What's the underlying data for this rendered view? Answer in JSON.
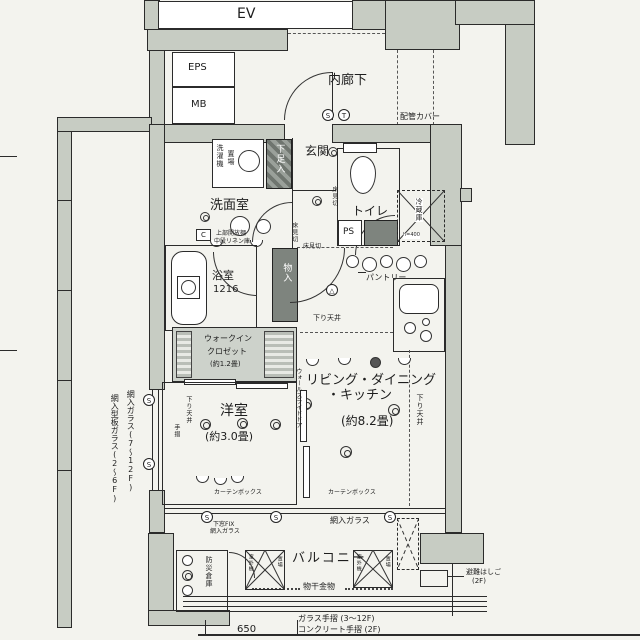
{
  "colors": {
    "wall": "#c7ccc3",
    "paper": "#f3f3ee",
    "line": "#2b2b2b",
    "dark_box": "#7e847e",
    "wic_tint": "#cdd2cb"
  },
  "plan": {
    "ev": "EV",
    "eps": "EPS",
    "mb": "MB",
    "corridor": "内廊下",
    "pipe_cover": "配管カバー",
    "entrance": "玄関",
    "shoe_box": "下足入",
    "washer1": "洗濯機",
    "washer2": "置場",
    "washroom": "洗面室",
    "shelf1": "上部開放棚",
    "shelf2": "中段リネン庫",
    "c": "C",
    "toilet": "トイレ",
    "ps": "PS",
    "fridge": "冷蔵庫",
    "fridge_note": "h=400",
    "pantry": "パントリー",
    "bath": "浴室",
    "bath_size": "1216",
    "closet": "物入",
    "floor_div": "床見切",
    "low_ceil": "下り天井",
    "ldk1": "リビング・ダイニング",
    "ldk2": "・キッチン",
    "ldk_size": "(約8.2畳)",
    "wic1": "ウォークイン",
    "wic2": "クロゼット",
    "wic_size": "(約1.2畳)",
    "bedroom": "洋室",
    "bedroom_size": "(約3.0畳)",
    "slide_door": "ウォールスライドドア",
    "handrail": "手摺",
    "curtain": "カーテンボックス",
    "glass1": "網入ガラス(7〜12F)",
    "glass2": "網入型板ガラス(2〜6F)",
    "wired_glass": "網入ガラス",
    "fix1": "下窓FIX",
    "fix2": "網入ガラス",
    "balcony": "バルコニー",
    "laundry": "物干金物",
    "unit1": "室外機",
    "unit2": "置場",
    "ladder1": "避難はしご",
    "ladder2": "(2F)",
    "disaster": "防災倉庫",
    "rail1": "ガラス手摺 (3〜12F)",
    "rail2": "コンクリート手摺 (2F)",
    "scale": "650",
    "s": "S",
    "t": "T"
  }
}
